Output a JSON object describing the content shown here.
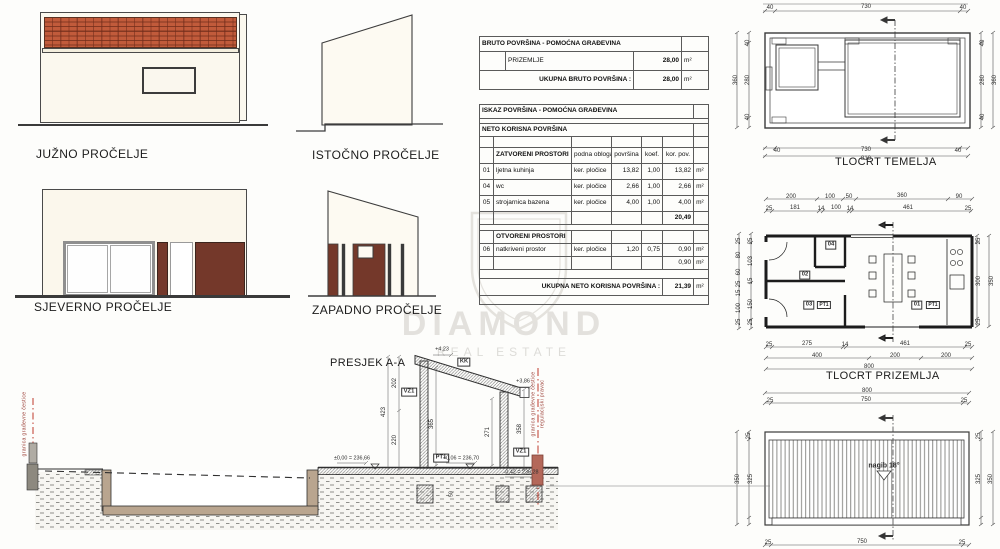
{
  "labels": {
    "south": "JUŽNO PROČELJE",
    "east": "ISTOČNO PROČELJE",
    "north": "SJEVERNO PROČELJE",
    "west": "ZAPADNO PROČELJE",
    "section": "PRESJEK A-A",
    "foundation": "TLOCRT TEMELJA",
    "ground": "TLOCRT PRIZEMLJA"
  },
  "bruto": {
    "title": "BRUTO POVRŠINA - POMOĆNA GRAĐEVINA",
    "row": {
      "label": "PRIZEMLJE",
      "value": "28,00",
      "unit": "m²"
    },
    "total": {
      "label": "UKUPNA BRUTO POVRŠINA :",
      "value": "28,00",
      "unit": "m²"
    }
  },
  "iskaz": {
    "title": "ISKAZ POVRŠINA - POMOĆNA GRAĐEVINA",
    "neto": "NETO KORISNA POVRŠINA",
    "h": {
      "name": "ZATVORENI PROSTORI",
      "floor": "podna obloga",
      "area": "površina",
      "koef": "koef.",
      "kor": "kor. pov."
    },
    "rows": [
      {
        "num": "01",
        "name": "ljetna kuhinja",
        "floor": "ker. pločice",
        "area": "13,82",
        "koef": "1,00",
        "kor": "13,82",
        "unit": "m²"
      },
      {
        "num": "04",
        "name": "wc",
        "floor": "ker. pločice",
        "area": "2,66",
        "koef": "1,00",
        "kor": "2,66",
        "unit": "m²"
      },
      {
        "num": "05",
        "name": "strojarnica bazena",
        "floor": "ker. pločice",
        "area": "4,00",
        "koef": "1,00",
        "kor": "4,00",
        "unit": "m²"
      }
    ],
    "subtotal": "20,49",
    "open": {
      "title": "OTVORENI PROSTORI",
      "row": {
        "num": "06",
        "name": "natkriveni prostor",
        "floor": "ker. pločice",
        "area": "1,20",
        "koef": "0,75",
        "kor": "0,90",
        "unit": "m²"
      }
    },
    "open_subtotal": "0,90",
    "unit": "m²",
    "total": {
      "label": "UKUPNA NETO KORISNA POVRŠINA :",
      "value": "21,39",
      "unit": "m²"
    }
  },
  "watermark": {
    "line1": "DIAMOND",
    "line2": "REAL ESTATE"
  },
  "colors": {
    "brick": "#c15b3b",
    "panel_brown": "#74382a",
    "cream": "#fbf8ee",
    "line": "#333333",
    "boundary_red": "#c0392b",
    "watermark": "#d0cec7"
  },
  "annotations": [
    {
      "t": "40",
      "x": 770,
      "y": 8
    },
    {
      "t": "730",
      "x": 866,
      "y": 7
    },
    {
      "t": "40",
      "x": 963,
      "y": 8
    },
    {
      "t": "40",
      "x": 748,
      "y": 43,
      "r": 1
    },
    {
      "t": "280",
      "x": 748,
      "y": 80,
      "r": 1
    },
    {
      "t": "40",
      "x": 748,
      "y": 117,
      "r": 1
    },
    {
      "t": "360",
      "x": 736,
      "y": 80,
      "r": 1
    },
    {
      "t": "40",
      "x": 983,
      "y": 43,
      "r": 1
    },
    {
      "t": "280",
      "x": 983,
      "y": 80,
      "r": 1
    },
    {
      "t": "40",
      "x": 983,
      "y": 117,
      "r": 1
    },
    {
      "t": "360",
      "x": 995,
      "y": 80,
      "r": 1
    },
    {
      "t": "40",
      "x": 777,
      "y": 151
    },
    {
      "t": "730",
      "x": 866,
      "y": 150
    },
    {
      "t": "40",
      "x": 958,
      "y": 151
    },
    {
      "t": "810",
      "x": 866,
      "y": 159
    },
    {
      "t": "200",
      "x": 791,
      "y": 197
    },
    {
      "t": "100",
      "x": 830,
      "y": 197
    },
    {
      "t": "50",
      "x": 849,
      "y": 197
    },
    {
      "t": "360",
      "x": 902,
      "y": 196
    },
    {
      "t": "90",
      "x": 959,
      "y": 197
    },
    {
      "t": "25",
      "x": 769,
      "y": 209
    },
    {
      "t": "181",
      "x": 795,
      "y": 208
    },
    {
      "t": "14",
      "x": 821,
      "y": 209
    },
    {
      "t": "100",
      "x": 836,
      "y": 208
    },
    {
      "t": "14",
      "x": 850,
      "y": 209
    },
    {
      "t": "461",
      "x": 908,
      "y": 208
    },
    {
      "t": "25",
      "x": 968,
      "y": 209
    },
    {
      "t": "25",
      "x": 769,
      "y": 345
    },
    {
      "t": "275",
      "x": 807,
      "y": 344
    },
    {
      "t": "14",
      "x": 845,
      "y": 345
    },
    {
      "t": "461",
      "x": 905,
      "y": 344
    },
    {
      "t": "25",
      "x": 968,
      "y": 345
    },
    {
      "t": "400",
      "x": 817,
      "y": 356
    },
    {
      "t": "200",
      "x": 895,
      "y": 356
    },
    {
      "t": "200",
      "x": 946,
      "y": 356
    },
    {
      "t": "800",
      "x": 869,
      "y": 367
    },
    {
      "t": "25",
      "x": 751,
      "y": 241,
      "r": 1
    },
    {
      "t": "103",
      "x": 751,
      "y": 261,
      "r": 1
    },
    {
      "t": "15",
      "x": 751,
      "y": 281,
      "r": 1
    },
    {
      "t": "150",
      "x": 751,
      "y": 304,
      "r": 1
    },
    {
      "t": "25",
      "x": 751,
      "y": 322,
      "r": 1
    },
    {
      "t": "25",
      "x": 739,
      "y": 241,
      "r": 1
    },
    {
      "t": "80",
      "x": 739,
      "y": 255,
      "r": 1
    },
    {
      "t": "60",
      "x": 739,
      "y": 272,
      "r": 1
    },
    {
      "t": "25",
      "x": 739,
      "y": 284,
      "r": 1
    },
    {
      "t": "15",
      "x": 739,
      "y": 293,
      "r": 1
    },
    {
      "t": "100",
      "x": 739,
      "y": 308,
      "r": 1
    },
    {
      "t": "25",
      "x": 739,
      "y": 322,
      "r": 1
    },
    {
      "t": "25",
      "x": 979,
      "y": 241,
      "r": 1
    },
    {
      "t": "300",
      "x": 979,
      "y": 281,
      "r": 1
    },
    {
      "t": "25",
      "x": 979,
      "y": 322,
      "r": 1
    },
    {
      "t": "350",
      "x": 992,
      "y": 281,
      "r": 1
    },
    {
      "t": "04",
      "x": 831,
      "y": 245,
      "b": 1
    },
    {
      "t": "02",
      "x": 805,
      "y": 275,
      "b": 1
    },
    {
      "t": "03",
      "x": 809,
      "y": 305,
      "b": 1
    },
    {
      "t": "PT1",
      "x": 824,
      "y": 305,
      "b": 1,
      "c": "sm"
    },
    {
      "t": "01",
      "x": 917,
      "y": 305,
      "b": 1
    },
    {
      "t": "PT1",
      "x": 933,
      "y": 305,
      "b": 1,
      "c": "sm"
    },
    {
      "t": "800",
      "x": 867,
      "y": 391
    },
    {
      "t": "25",
      "x": 770,
      "y": 401
    },
    {
      "t": "750",
      "x": 866,
      "y": 400
    },
    {
      "t": "25",
      "x": 964,
      "y": 401
    },
    {
      "t": "25",
      "x": 749,
      "y": 436,
      "r": 1
    },
    {
      "t": "325",
      "x": 751,
      "y": 479,
      "r": 1
    },
    {
      "t": "350",
      "x": 738,
      "y": 479,
      "r": 1
    },
    {
      "t": "25",
      "x": 979,
      "y": 436,
      "r": 1
    },
    {
      "t": "325",
      "x": 979,
      "y": 479,
      "r": 1
    },
    {
      "t": "350",
      "x": 991,
      "y": 479,
      "r": 1
    },
    {
      "t": "nagib 18°",
      "x": 884,
      "y": 466,
      "c": "slope"
    },
    {
      "t": "25",
      "x": 768,
      "y": 543
    },
    {
      "t": "750",
      "x": 862,
      "y": 542
    },
    {
      "t": "25",
      "x": 962,
      "y": 543
    },
    {
      "t": "+4,23",
      "x": 442,
      "y": 350,
      "c": "elev"
    },
    {
      "t": "KK",
      "x": 464,
      "y": 362,
      "b": 1
    },
    {
      "t": "+3,86",
      "x": 523,
      "y": 382,
      "c": "elev"
    },
    {
      "t": "VZ1",
      "x": 409,
      "y": 392,
      "b": 1
    },
    {
      "t": "VZ1",
      "x": 521,
      "y": 452,
      "b": 1
    },
    {
      "t": "PT1",
      "x": 441,
      "y": 458,
      "b": 1
    },
    {
      "t": "202",
      "x": 395,
      "y": 383,
      "r": 1
    },
    {
      "t": "423",
      "x": 384,
      "y": 412,
      "r": 1
    },
    {
      "t": "220",
      "x": 395,
      "y": 440,
      "r": 1
    },
    {
      "t": "365",
      "x": 432,
      "y": 424,
      "r": 1
    },
    {
      "t": "271",
      "x": 488,
      "y": 432,
      "r": 1
    },
    {
      "t": "358",
      "x": 520,
      "y": 429,
      "r": 1
    },
    {
      "t": "50",
      "x": 452,
      "y": 494,
      "r": 1,
      "c": "tiny"
    },
    {
      "t": "±0,00 = 236,66",
      "x": 352,
      "y": 459,
      "c": "elev"
    },
    {
      "t": "+0,06 = 236,70",
      "x": 461,
      "y": 459,
      "c": "elev"
    },
    {
      "t": "-0,42 = 236,28",
      "x": 521,
      "y": 473,
      "c": "elev"
    },
    {
      "t": "granica građevne čestice",
      "x": 534,
      "y": 404,
      "r": 1,
      "c": "bnd"
    },
    {
      "t": "regulacijski pravac",
      "x": 543,
      "y": 404,
      "r": 1,
      "c": "bnd"
    },
    {
      "t": "granica građevne čestice",
      "x": 25,
      "y": 424,
      "r": 1,
      "c": "bnd"
    }
  ]
}
